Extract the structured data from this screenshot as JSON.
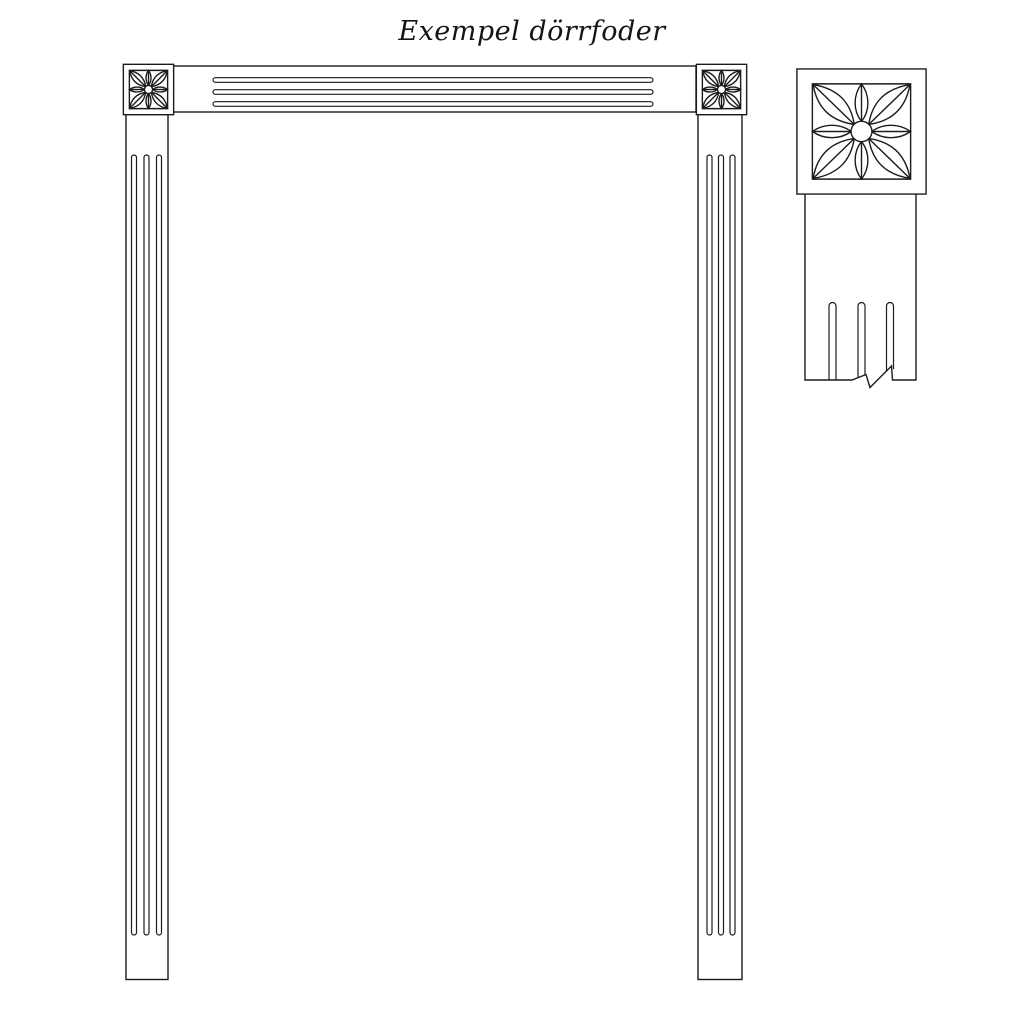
{
  "title": "Exempel dörrfoder",
  "colors": {
    "line": "#1b1b1b",
    "background": "#ffffff"
  },
  "figure": {
    "type": "technical line drawing",
    "subject": "door casing example (dörrfoder)",
    "parts": [
      "corner-rosette-block-top-left",
      "fluted-head-casing",
      "corner-rosette-block-top-right",
      "fluted-side-casing-left",
      "fluted-side-casing-right",
      "detail-corner-rosette-with-fluted-casing"
    ]
  }
}
